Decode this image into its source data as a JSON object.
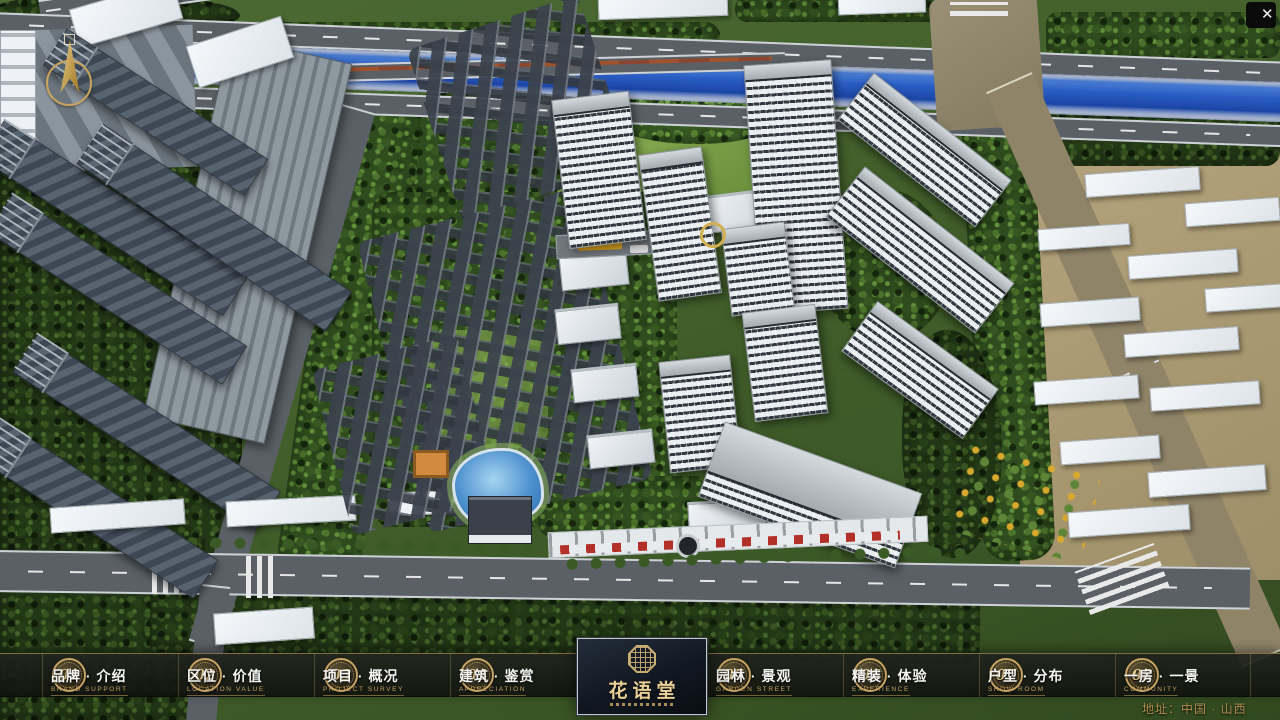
{
  "ui": {
    "close_icon": "✕",
    "address": "地址：中国 · 山西"
  },
  "logo": {
    "title": "花语堂"
  },
  "nav": {
    "items": [
      {
        "num": "01",
        "label": "品牌 · 介绍",
        "sub": "BRAND SUPPORT"
      },
      {
        "num": "02",
        "label": "区位 · 价值",
        "sub": "LOCATION VALUE"
      },
      {
        "num": "03",
        "label": "项目 · 概况",
        "sub": "PROJECT SURVEY"
      },
      {
        "num": "04",
        "label": "建筑 · 鉴赏",
        "sub": "APPRECIATION"
      },
      {
        "num": "05",
        "label": "园林 · 景观",
        "sub": "GARDEN STREET"
      },
      {
        "num": "06",
        "label": "精装 · 体验",
        "sub": "EXPERIENCE"
      },
      {
        "num": "07",
        "label": "户型 · 分布",
        "sub": "SHOW ROOM"
      },
      {
        "num": "08",
        "label": "一房 · 一景",
        "sub": "COMMUNITY"
      }
    ]
  },
  "colors": {
    "gold": "#c9a96b",
    "bar_background": "rgba(22,26,22,0.9)",
    "river_blue": "#2a5ec4"
  }
}
